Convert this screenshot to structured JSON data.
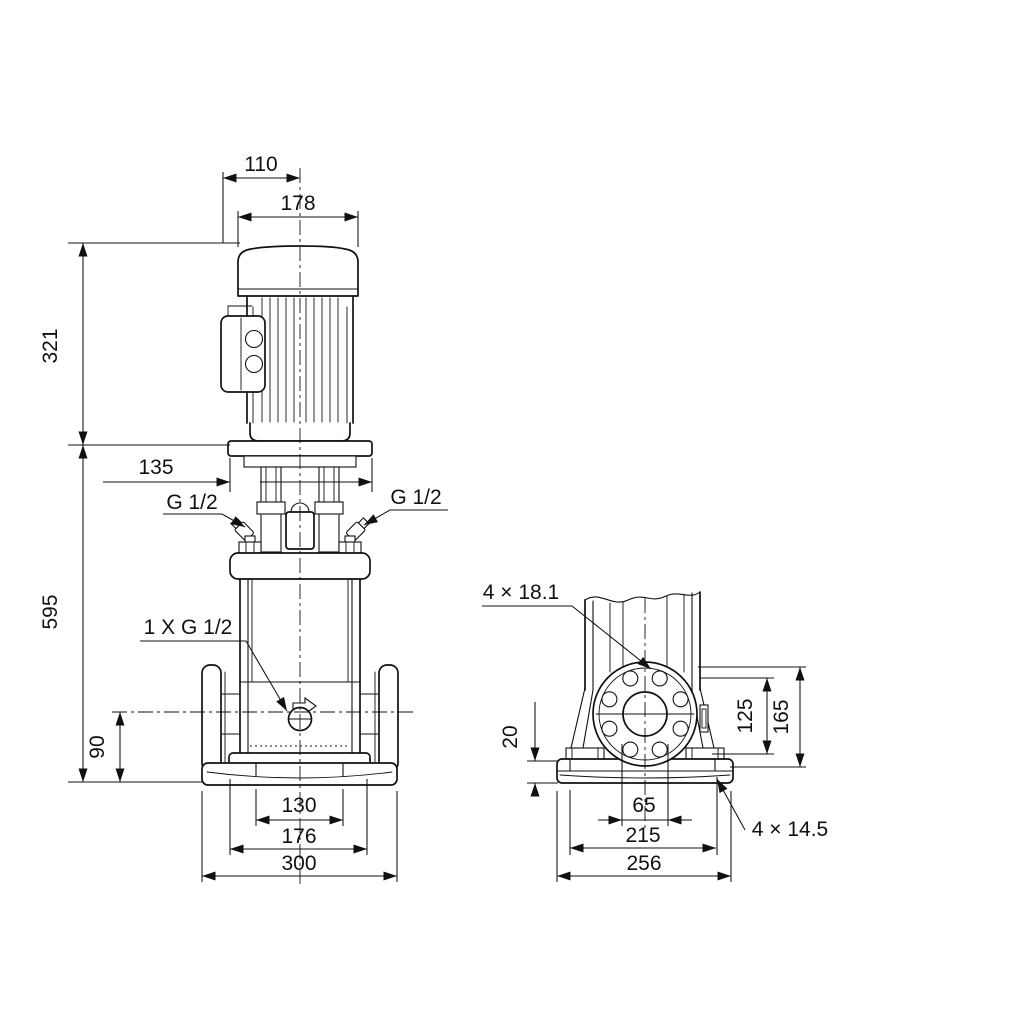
{
  "meta": {
    "background_color": "#ffffff",
    "line_color": "#111111",
    "drawing_type": "pump dimensional outline drawing",
    "views": [
      "front view with motor",
      "side view of flange and base"
    ]
  },
  "front_view": {
    "labels": {
      "dim_110": "110",
      "dim_178": "178",
      "dim_321": "321",
      "dim_135": "135",
      "dim_595": "595",
      "dim_90": "90",
      "dim_130": "130",
      "dim_176": "176",
      "dim_300": "300",
      "vent_left": "G 1/2",
      "vent_right": "G 1/2",
      "drain": "1 X G 1/2"
    }
  },
  "side_view": {
    "labels": {
      "flange_holes": "4 × 18.1",
      "dim_20": "20",
      "dim_125": "125",
      "dim_165": "165",
      "dim_65": "65",
      "dim_215": "215",
      "dim_256": "256",
      "base_holes": "4 × 14.5"
    }
  }
}
